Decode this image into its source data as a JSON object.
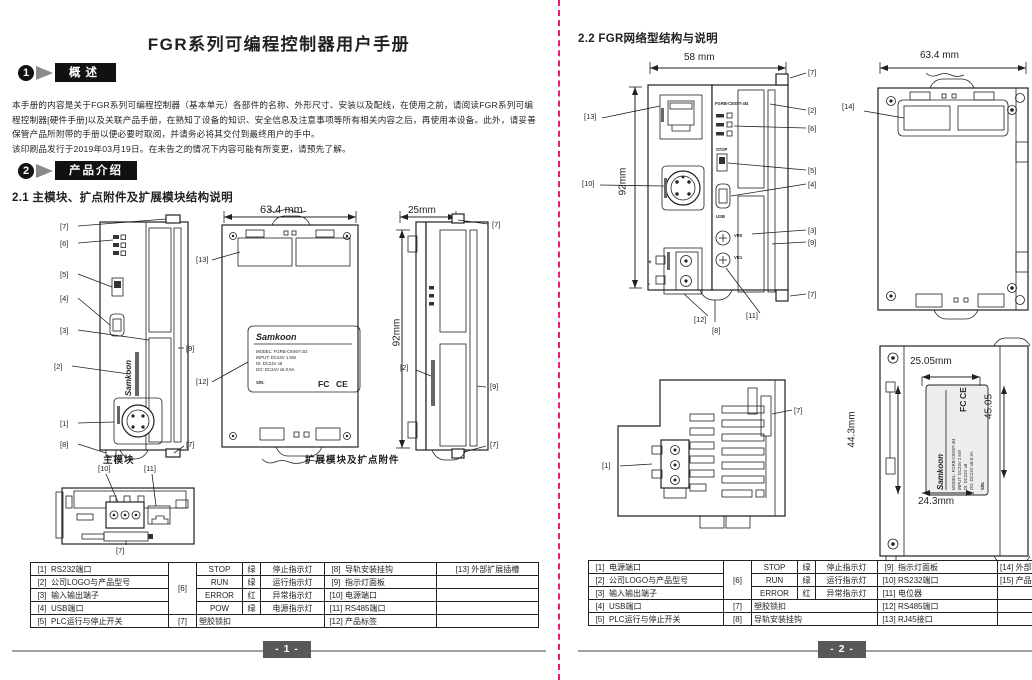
{
  "callouts": {
    "c1": "[1]",
    "c2": "[2]",
    "c3": "[3]",
    "c4": "[4]",
    "c5": "[5]",
    "c6": "[6]",
    "c7": "[7]",
    "c8": "[8]",
    "c9": "[9]",
    "c10": "[10]",
    "c11": "[11]",
    "c12": "[12]",
    "c13": "[13]",
    "c14": "[14]",
    "c15": "[15]"
  },
  "left_page": {
    "title": "FGR系列可编程控制器用户手册",
    "section1_num": "1",
    "section1_label": "概述",
    "section2_num": "2",
    "section2_label": "产品介绍",
    "intro_lines": [
      "本手册的内容是关于FGR系列可编程控制器（基本单元）各部件的名称、外形尺寸、安装以及配线，在使用之前，请阅读FGR系列可编",
      "程控制器[硬件手册]以及关联产品手册，在熟知了设备的知识、安全信息及注意事项等所有相关内容之后，再使用本设备。此外，请妥善",
      "保管产品所附带的手册以便必要时取阅，并请务必将其交付到最终用户的手中。",
      "该印刷品发行于2019年03月19日。在未告之的情况下内容可能有所变更，请预先了解。"
    ],
    "heading_2_1": "2.1 主模块、扩点附件及扩展模块结构说明",
    "dims": {
      "w634": "63.4 mm",
      "w25": "25mm",
      "h92": "92mm"
    },
    "captions": {
      "main": "主模块",
      "expansion": "扩展模块及扩点附件"
    },
    "sticker": {
      "brand": "Samkoon",
      "lines": [
        "MODEL: FGRB-C8X6T-2I2",
        "INPUT: DC24V   1.5W",
        "DI: DC24V x8",
        "DO: DC24V x6   0.5A"
      ],
      "sn": "S/N:",
      "fc": "FC",
      "ce": "CE"
    },
    "micro": {
      "brand": "Samkoon"
    },
    "table": {
      "items_left": [
        [
          "[1]",
          "RS232端口"
        ],
        [
          "[2]",
          "公司LOGO与产品型号"
        ],
        [
          "[3]",
          "输入输出端子"
        ],
        [
          "[4]",
          "USB端口"
        ],
        [
          "[5]",
          "PLC运行与停止开关"
        ]
      ],
      "ref6": "[6]",
      "leds": [
        [
          "STOP",
          "绿",
          "停止指示灯"
        ],
        [
          "RUN",
          "绿",
          "运行指示灯"
        ],
        [
          "ERROR",
          "红",
          "异常指示灯"
        ],
        [
          "POW",
          "绿",
          "电源指示灯"
        ]
      ],
      "ref7": "[7]",
      "ref7_label": "塑胶锁扣",
      "items_mid": [
        [
          "[8]",
          "导轨安装挂钩"
        ],
        [
          "[9]",
          "指示灯面板"
        ],
        [
          "[10]",
          "电源端口"
        ],
        [
          "[11]",
          "RS485端口"
        ],
        [
          "[12]",
          "产品标签"
        ]
      ],
      "items_right": [
        [
          "[13]",
          "外部扩展插槽"
        ]
      ]
    },
    "page_num": "- 1 -"
  },
  "right_page": {
    "heading_2_2": "2.2 FGR网络型结构与说明",
    "dims": {
      "w58": "58 mm",
      "h92": "92mm",
      "w634": "63.4 mm",
      "w2505": "25.05mm",
      "h443": "44.3mm",
      "h4505": "45.05",
      "w243": "24.3mm"
    },
    "sticker": {
      "brand": "Samkoon",
      "lines": [
        "MODEL: FGRB-C8X8T-4I4",
        "INPUT: DC24V   2.5W",
        "DI: DC24V x8",
        "DO: DC24V x8   0.3A"
      ],
      "sn": "S/N:",
      "fc": "FC",
      "ce": "CE"
    },
    "micro": {
      "model": "FGRB-C8X8T-4I4",
      "stop": "STOP",
      "usb": "USB",
      "vr0": "VR0",
      "vr1": "VR1",
      "plus": "+",
      "minus": "-"
    },
    "table": {
      "items_left": [
        [
          "[1]",
          "电源端口"
        ],
        [
          "[2]",
          "公司LOGO与产品型号"
        ],
        [
          "[3]",
          "输入输出端子"
        ],
        [
          "[4]",
          "USB端口"
        ],
        [
          "[5]",
          "PLC运行与停止开关"
        ]
      ],
      "ref6": "[6]",
      "leds": [
        [
          "STOP",
          "绿",
          "停止指示灯"
        ],
        [
          "RUN",
          "绿",
          "运行指示灯"
        ],
        [
          "ERROR",
          "红",
          "异常指示灯"
        ]
      ],
      "ref7": "[7]",
      "ref7_label": "塑胶锁扣",
      "ref8": "[8]",
      "ref8_label": "导轨安装挂钩",
      "items_mid": [
        [
          "[9]",
          "指示灯面板"
        ],
        [
          "[10]",
          "RS232端口"
        ],
        [
          "[11]",
          "电位器"
        ],
        [
          "[12]",
          "RS485端口"
        ],
        [
          "[13]",
          "RJ45接口"
        ]
      ],
      "items_right": [
        [
          "[14]",
          "外部"
        ],
        [
          "[15]",
          "产品"
        ]
      ]
    },
    "page_num": "- 2 -"
  }
}
